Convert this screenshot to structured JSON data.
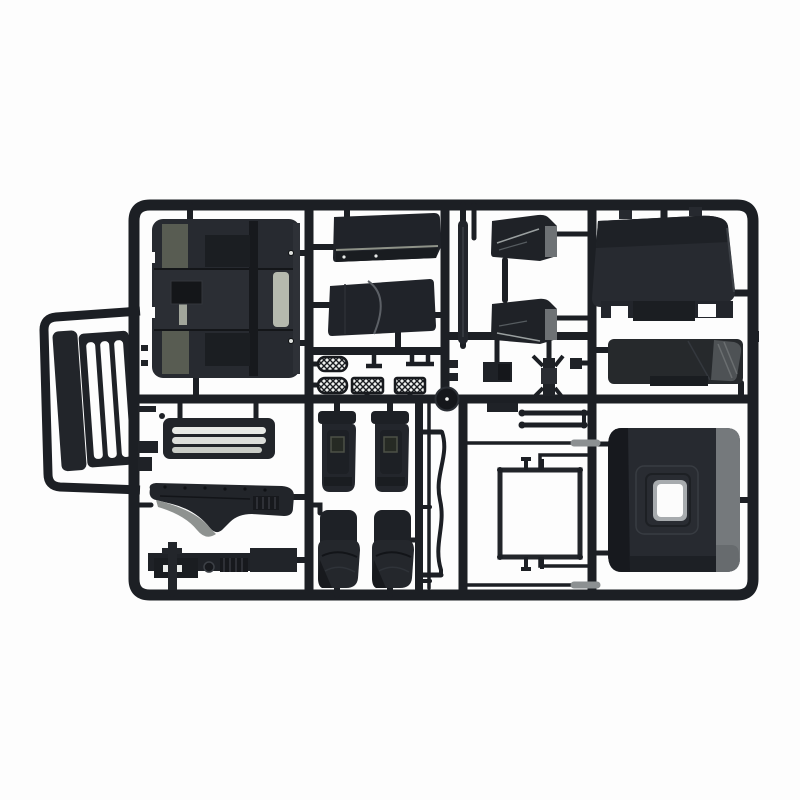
{
  "scene": {
    "kind": "product-photo",
    "subject": "black plastic model-kit sprue (injection-molded parts tree) of truck cab components on a white background",
    "visible_text": ""
  },
  "colors": {
    "background": "#fdfdfd",
    "frame": "#1c1f24",
    "plastic": "#22252a",
    "plastic_dark": "#15171b",
    "plastic_mid": "#272a30",
    "plastic_light": "#3a3e44",
    "olive_gray": "#585c52",
    "light_slat": "#b5b9ae",
    "gray_band": "#75797c",
    "gray_block": "#6e7275",
    "gray_light": "#9aa0a0",
    "swoosh_gray": "#8e9290",
    "mesh_bg": "#eef0ee",
    "white_detail": "#f2f3f1"
  },
  "parts": [
    {
      "id": "sprue-frame",
      "desc": "rectangular outer runner frame with internal runner bars"
    },
    {
      "id": "grille-assembly",
      "desc": "side sub-frame holding tilted radiator grille with slats"
    },
    {
      "id": "cab-floor-panel",
      "desc": "large cab floor / engine tunnel panel with gray inserts"
    },
    {
      "id": "side-panel-upper",
      "desc": "upper side body panel"
    },
    {
      "id": "side-panel-lower",
      "desc": "lower side body panel with seam"
    },
    {
      "id": "pillar-strip",
      "desc": "thin vertical pillar strip"
    },
    {
      "id": "door-wedge-upper",
      "desc": "upper wedge-shaped door part with gray end block"
    },
    {
      "id": "door-wedge-lower",
      "desc": "lower wedge-shaped door part with gray end block"
    },
    {
      "id": "roof-panel",
      "desc": "large roof panel with notched bottom lip"
    },
    {
      "id": "sleeper-bar",
      "desc": "long panel bar with light gray angled end"
    },
    {
      "id": "back-panel",
      "desc": "cab back panel with central window opening and gray side band"
    },
    {
      "id": "front-grille-slats",
      "desc": "horizontal slatted front grille panel"
    },
    {
      "id": "dashboard-piece",
      "desc": "curved dashboard / fender piece with gray swoosh"
    },
    {
      "id": "chassis-rail",
      "desc": "detailed chassis rail with pin, ring and ribs"
    },
    {
      "id": "mesh-steps",
      "desc": "four mesh-textured step plates"
    },
    {
      "id": "disc-part",
      "desc": "small round disc part at runner junction"
    },
    {
      "id": "seat-row-upper",
      "desc": "two seat backs with headrests"
    },
    {
      "id": "seat-row-lower",
      "desc": "two seat cushions with backrests"
    },
    {
      "id": "wavy-rod",
      "desc": "S-curved thin rod part"
    },
    {
      "id": "straight-rod",
      "desc": "straight thin rod part"
    },
    {
      "id": "ladder-part",
      "desc": "small two-bar ladder part"
    },
    {
      "id": "window-frame-square",
      "desc": "thin square window frame with stems"
    },
    {
      "id": "small-brackets",
      "desc": "small bracket and mirror-arm parts"
    }
  ]
}
